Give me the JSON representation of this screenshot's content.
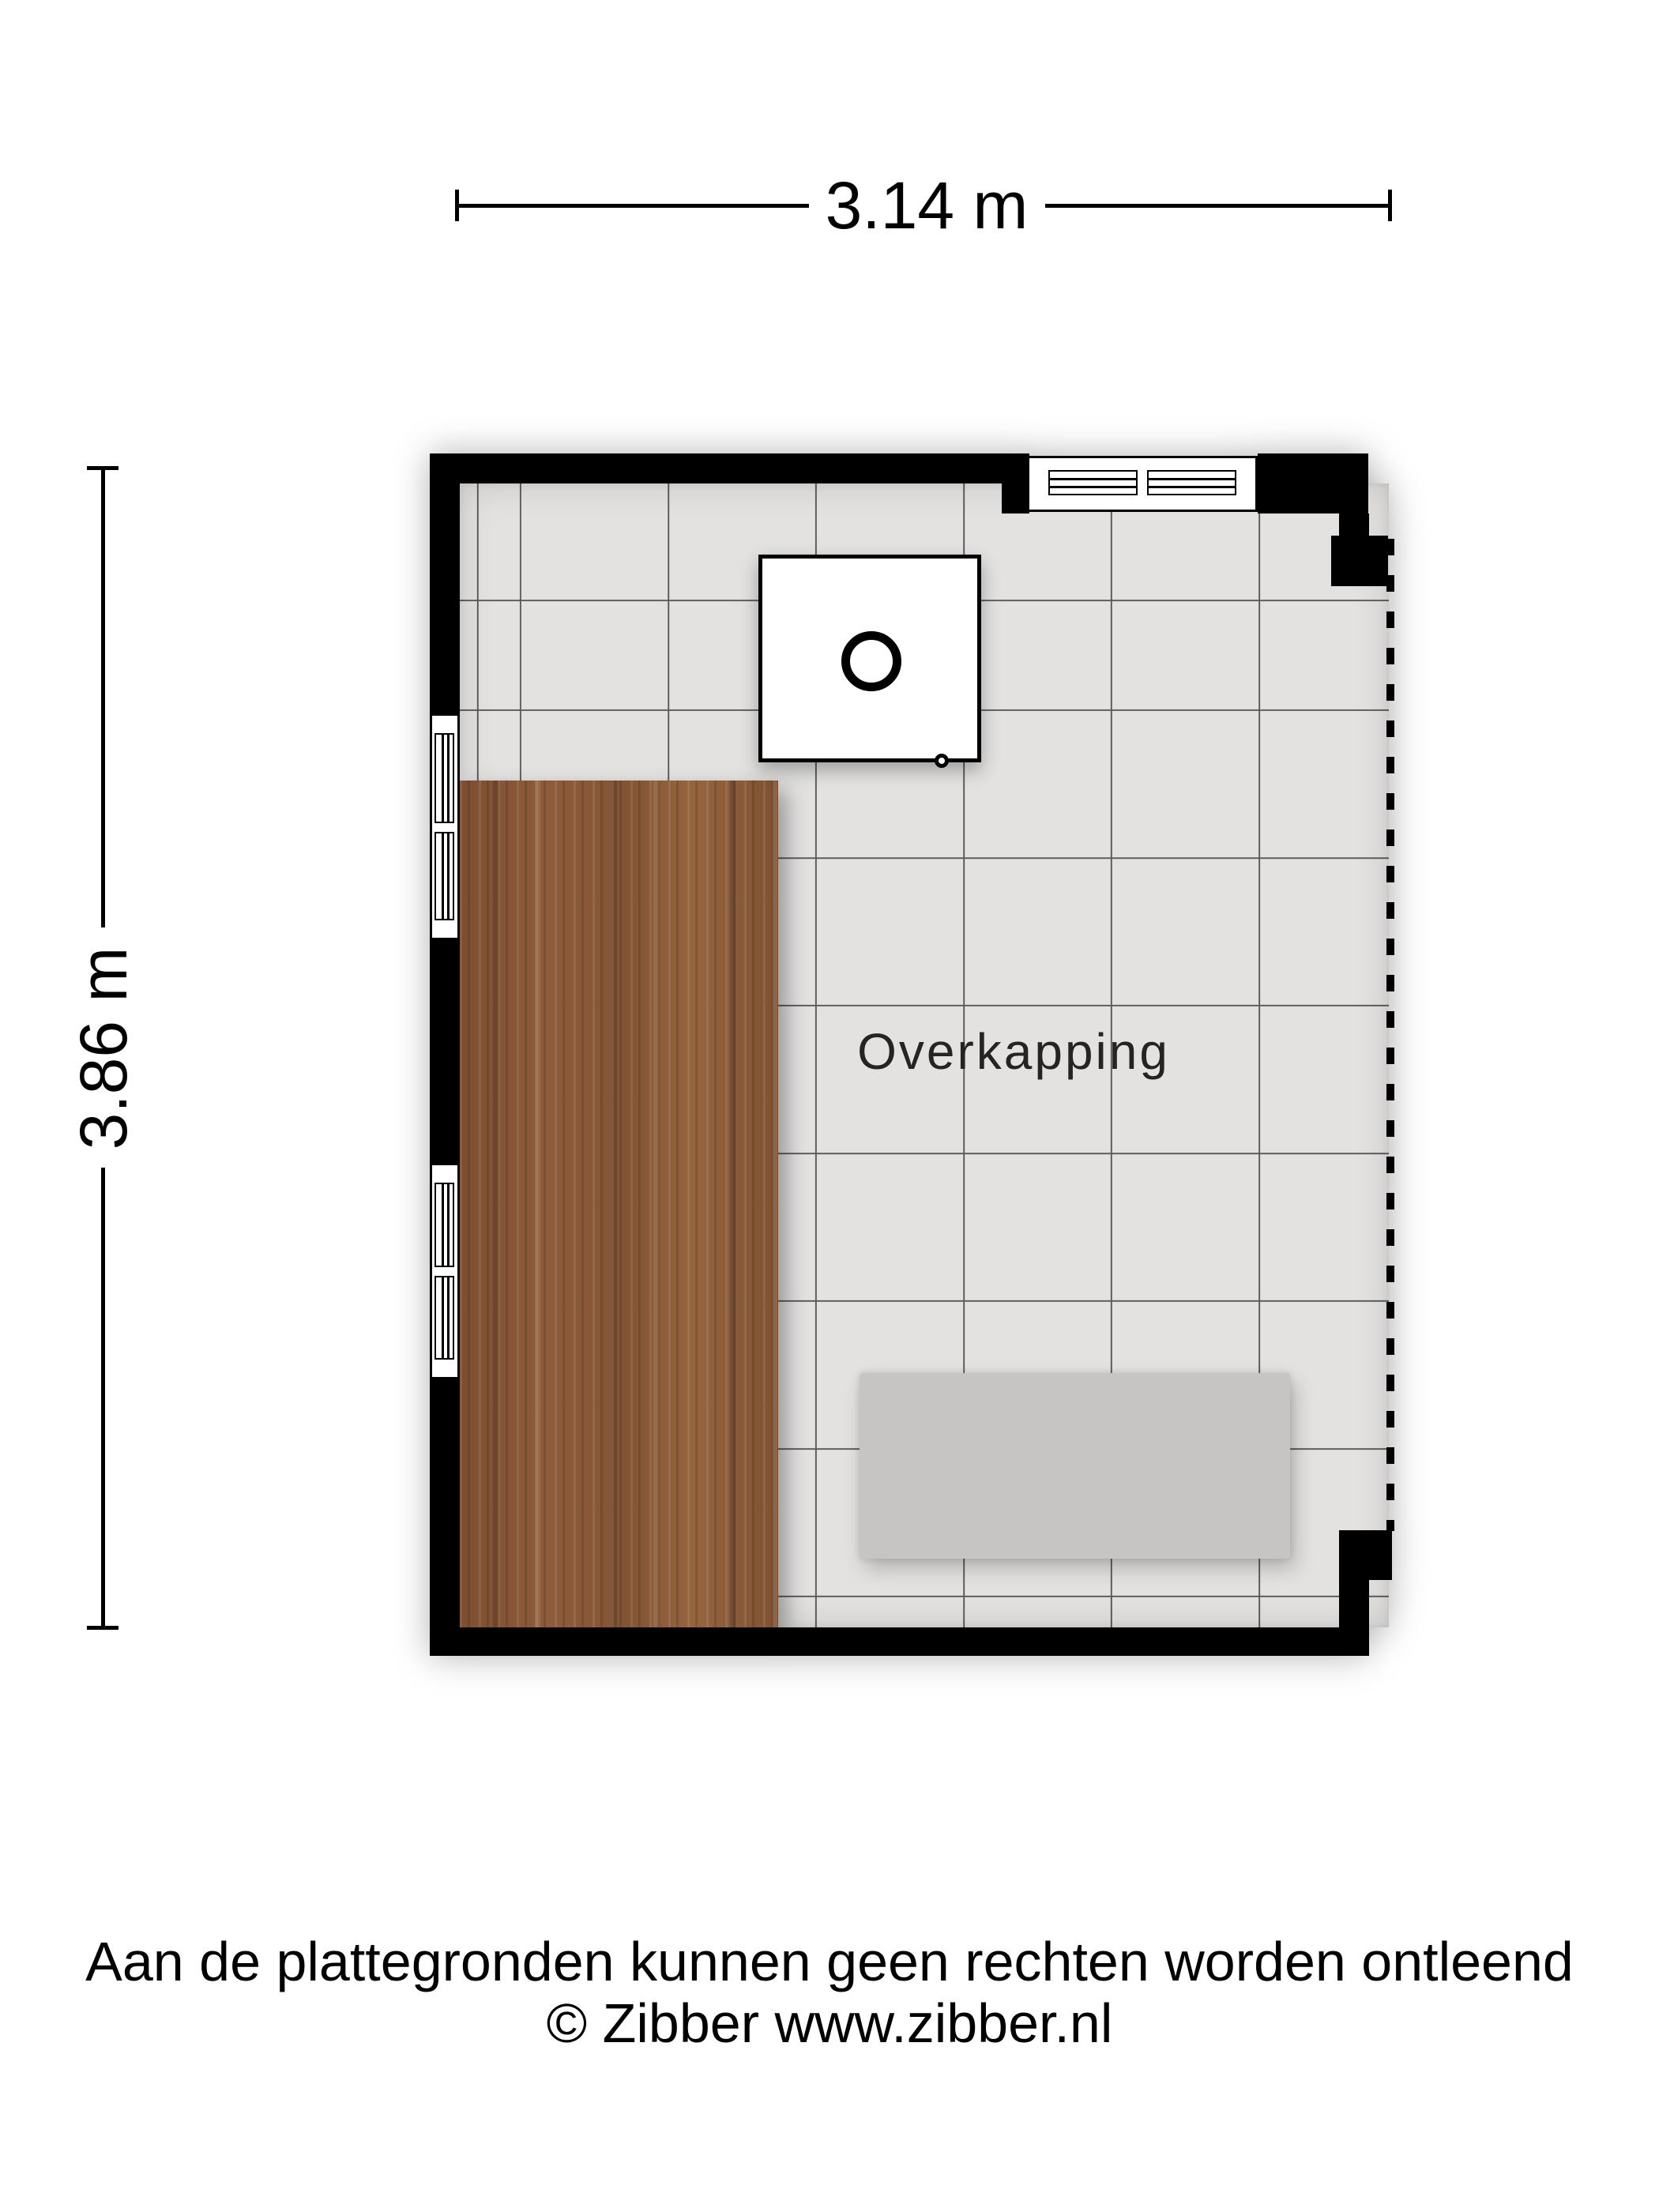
{
  "dimensions": {
    "width_label": "3.14 m",
    "height_label": "3.86 m"
  },
  "room": {
    "label": "Overkapping"
  },
  "footer": {
    "disclaimer": "Aan de plattegronden kunnen geen rechten worden ontleend",
    "copyright": "© Zibber www.zibber.nl"
  },
  "colors": {
    "background": "#ffffff",
    "wall": "#000000",
    "floor": "#e3e2e1",
    "grid": "#5a5a5a",
    "wood": "#8a5737",
    "bench": "#c6c5c4",
    "window_fill": "#ffffff",
    "dashed": "#000000",
    "label": "#242424",
    "text": "#000000"
  }
}
